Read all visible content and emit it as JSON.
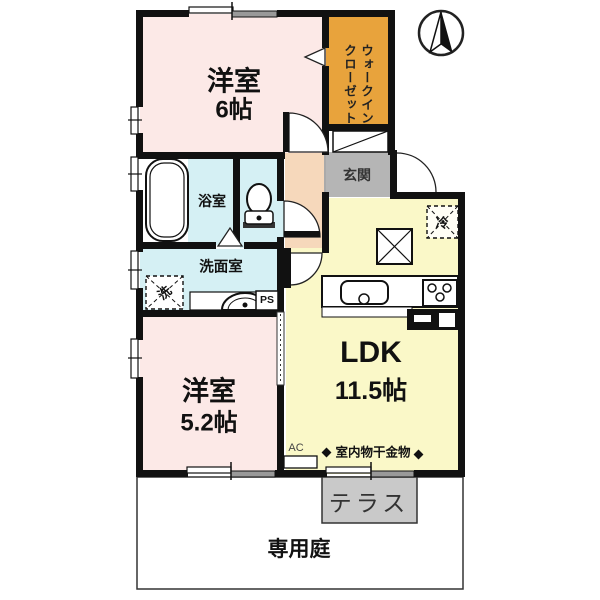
{
  "floorplan": {
    "type": "apartment-floorplan-1LDK+2BR",
    "compass": "north-up",
    "labels": {
      "bedroom1_name": "洋室",
      "bedroom1_size": "6帖",
      "wic_line1": "ウォークイン",
      "wic_line2": "クローゼット",
      "genkan": "玄関",
      "bath": "浴室",
      "washroom": "洗面室",
      "washer": "洗",
      "ps": "PS",
      "ldk_name": "LDK",
      "ldk_size": "11.5帖",
      "bedroom2_name": "洋室",
      "bedroom2_size": "5.2帖",
      "fridge": "冷",
      "ac": "AC",
      "laundry": "室内物干金物",
      "terrace": "テラス",
      "garden": "専用庭"
    },
    "fixtures": [
      "compass-north",
      "bathtub",
      "toilet",
      "washing-machine-space",
      "vanity-sink",
      "kitchen-sink",
      "gas-stove",
      "refrigerator-space",
      "air-conditioner",
      "indoor-laundry-hooks"
    ],
    "colors": {
      "wall": "#111111",
      "bedroom": "#fce9e7",
      "closet": "#e8a33c",
      "hallway": "#f6d8bb",
      "genkan": "#b5b5b5",
      "wet_area": "#d5f0f4",
      "ldk": "#faf8c8",
      "terrace": "#c9c9c9",
      "garden": "#ffffff"
    }
  }
}
